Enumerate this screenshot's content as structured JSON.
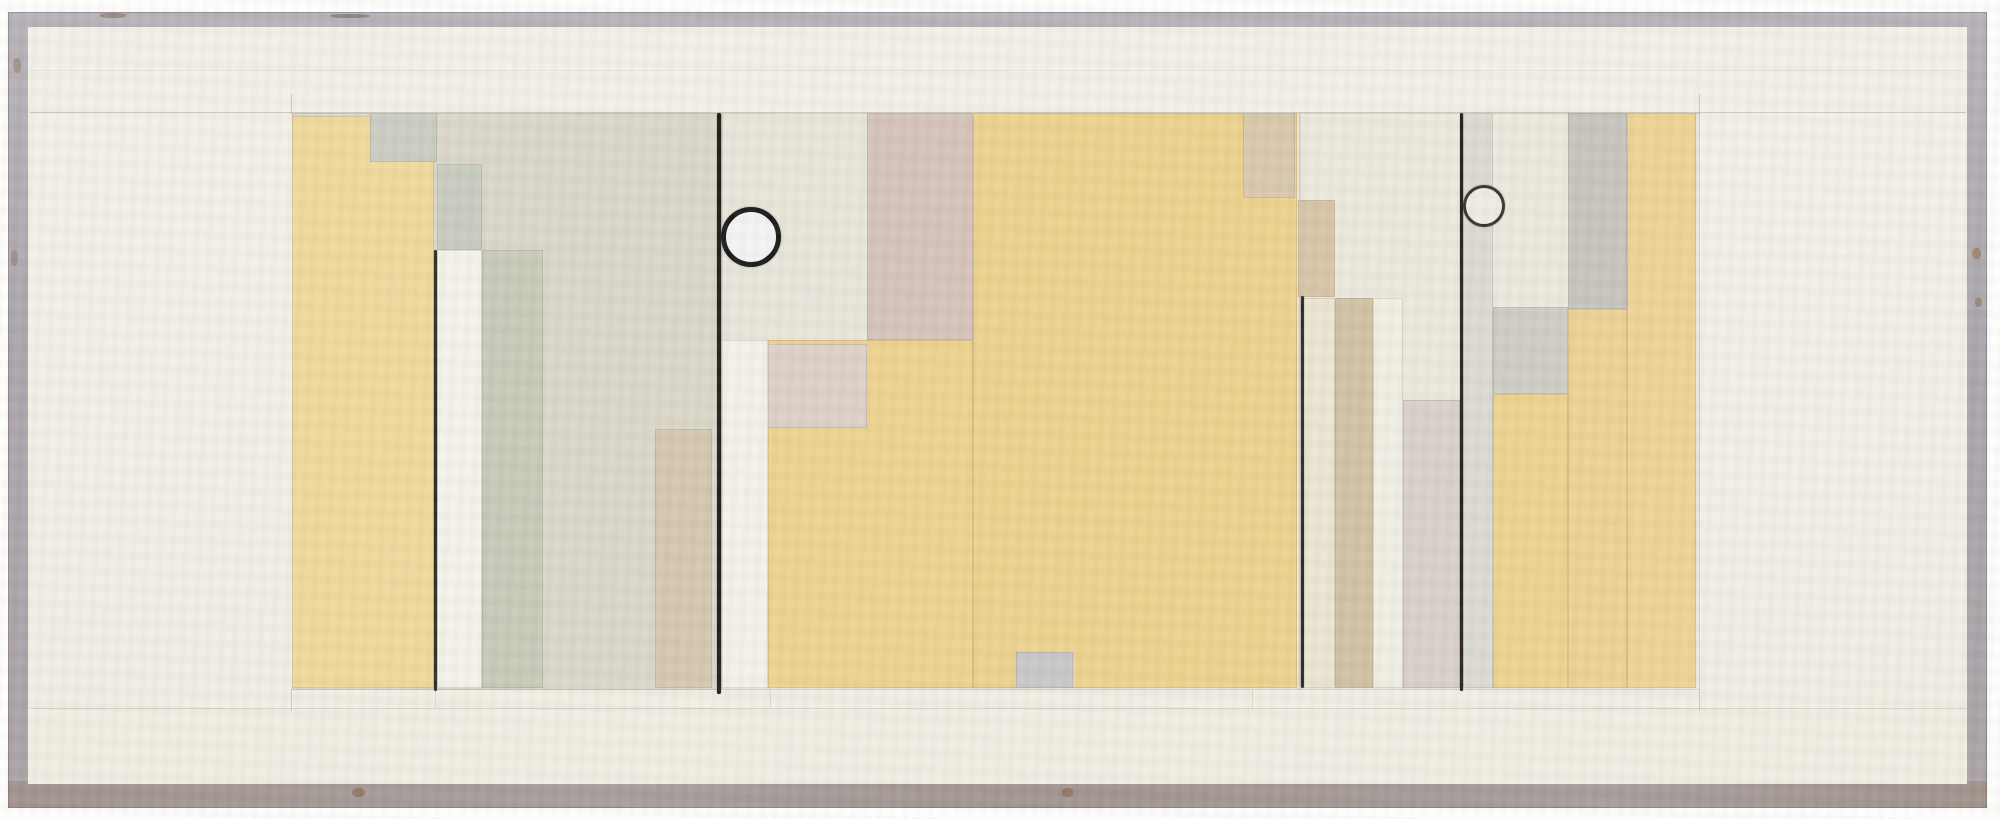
{
  "canvas": {
    "width": 2000,
    "height": 819
  },
  "palette": {
    "paper_outer": "#fdfdfc",
    "frame_gray": "#b2acb3",
    "frame_gray_dark": "#a39da5",
    "frame_rust": "#8a6a4a",
    "mat_cream": "#f1eee5",
    "graphite": "#1c1b17",
    "field_warm_gray": "#d9d6c9",
    "yellow_ochre": "#ecd18c",
    "pink_beige": "#d5c2b9",
    "olive_gray": "#c6c9b8",
    "tan_beige": "#d4c6ae",
    "white_paint": "#f4f2e8"
  },
  "frame": {
    "outer": {
      "x": 8,
      "y": 12,
      "w": 1979,
      "h": 796
    },
    "mat": {
      "x": 28,
      "y": 27,
      "w": 1939,
      "h": 757
    }
  },
  "composition": {
    "x": 292,
    "y": 113,
    "w": 1408,
    "h": 577
  },
  "shapes": [
    {
      "name": "field-left",
      "x": 292,
      "y": 113,
      "w": 430,
      "h": 577,
      "color": "#d9d6c9"
    },
    {
      "name": "field-middle",
      "x": 722,
      "y": 113,
      "w": 578,
      "h": 577,
      "color": "#e7e5da"
    },
    {
      "name": "field-right",
      "x": 1300,
      "y": 113,
      "w": 400,
      "h": 577,
      "color": "#eae8dd"
    },
    {
      "name": "yellow-block-left",
      "x": 292,
      "y": 116,
      "w": 142,
      "h": 572,
      "color": "#eed99b"
    },
    {
      "name": "gray-notch-square",
      "x": 370,
      "y": 113,
      "w": 67,
      "h": 49,
      "color": "#c9ccc1"
    },
    {
      "name": "gray-strip-upper",
      "x": 437,
      "y": 164,
      "w": 45,
      "h": 86,
      "color": "#c7cbbe"
    },
    {
      "name": "white-strip-left",
      "x": 437,
      "y": 250,
      "w": 45,
      "h": 438,
      "color": "#f4f2e8"
    },
    {
      "name": "olive-strip",
      "x": 482,
      "y": 250,
      "w": 61,
      "h": 438,
      "color": "#c6c9b8"
    },
    {
      "name": "tan-strip-left",
      "x": 655,
      "y": 429,
      "w": 57,
      "h": 259,
      "color": "#d4c6ae"
    },
    {
      "name": "white-strip-middle",
      "x": 722,
      "y": 340,
      "w": 46,
      "h": 348,
      "color": "#f3f1e7"
    },
    {
      "name": "yellow-field-lower",
      "x": 768,
      "y": 340,
      "w": 205,
      "h": 348,
      "color": "#ecd28e"
    },
    {
      "name": "pale-pink-rect",
      "x": 768,
      "y": 344,
      "w": 99,
      "h": 84,
      "color": "#dccfc7"
    },
    {
      "name": "deep-pink-rect",
      "x": 867,
      "y": 113,
      "w": 106,
      "h": 227,
      "color": "#d5c2b9"
    },
    {
      "name": "yellow-field-main",
      "x": 973,
      "y": 113,
      "w": 324,
      "h": 575,
      "color": "#ecd18c"
    },
    {
      "name": "tan-rect-top",
      "x": 1243,
      "y": 113,
      "w": 52,
      "h": 85,
      "color": "#d8c7aa"
    },
    {
      "name": "small-gray-square",
      "x": 1016,
      "y": 652,
      "w": 57,
      "h": 36,
      "color": "#c6c6c9"
    },
    {
      "name": "tan-rect-mid",
      "x": 1298,
      "y": 200,
      "w": 37,
      "h": 97,
      "color": "#d6c5a7"
    },
    {
      "name": "cream-strip-right",
      "x": 1303,
      "y": 298,
      "w": 32,
      "h": 390,
      "color": "#eae4d3"
    },
    {
      "name": "tan-strip-right",
      "x": 1335,
      "y": 298,
      "w": 38,
      "h": 390,
      "color": "#cfc1a3"
    },
    {
      "name": "white-strip-right",
      "x": 1373,
      "y": 298,
      "w": 30,
      "h": 390,
      "color": "#f0eee3"
    },
    {
      "name": "pinkgray-strip-right",
      "x": 1403,
      "y": 400,
      "w": 57,
      "h": 288,
      "color": "#d9cecb"
    },
    {
      "name": "gray-strip-rightline",
      "x": 1463,
      "y": 113,
      "w": 30,
      "h": 575,
      "color": "#dbd9d1"
    },
    {
      "name": "gray-square-right",
      "x": 1493,
      "y": 307,
      "w": 75,
      "h": 87,
      "color": "#cecbc5"
    },
    {
      "name": "darkgray-strip-right",
      "x": 1568,
      "y": 113,
      "w": 59,
      "h": 196,
      "color": "#c6c3bc"
    },
    {
      "name": "yellow-strip-right-mid",
      "x": 1568,
      "y": 309,
      "w": 59,
      "h": 379,
      "color": "#ecd192"
    },
    {
      "name": "yellow-block-right",
      "x": 1627,
      "y": 113,
      "w": 69,
      "h": 575,
      "color": "#edd293"
    },
    {
      "name": "yellow-block-right-lower",
      "x": 1493,
      "y": 394,
      "w": 75,
      "h": 294,
      "color": "#ecd28f"
    }
  ],
  "lines": [
    {
      "name": "black-line-left-short",
      "x": 434,
      "y": 250,
      "w": 3,
      "h": 441,
      "color": "#2b2924"
    },
    {
      "name": "black-line-main-left",
      "x": 717,
      "y": 113,
      "w": 4,
      "h": 581,
      "color": "#1c1b17"
    },
    {
      "name": "black-line-right-short",
      "x": 1301,
      "y": 296,
      "w": 3,
      "h": 392,
      "color": "#2b2924"
    },
    {
      "name": "black-line-main-right",
      "x": 1460,
      "y": 113,
      "w": 3,
      "h": 578,
      "color": "#221f1c"
    }
  ],
  "circles": [
    {
      "name": "circle-left",
      "cx": 751,
      "cy": 237,
      "r": 30,
      "ring": 5,
      "ring_color": "#161616",
      "fill": "#f2f3f4"
    },
    {
      "name": "circle-right",
      "cx": 1484,
      "cy": 206,
      "r": 21,
      "ring": 3,
      "ring_color": "#33312d",
      "fill": "#edebe2"
    }
  ],
  "pencil_lines": [
    {
      "name": "pencil-top-rule",
      "x": 30,
      "y": 112,
      "w": 1936,
      "h": 1,
      "opacity": 0.3
    },
    {
      "name": "pencil-upper-faint-rule",
      "x": 30,
      "y": 70,
      "w": 1936,
      "h": 1,
      "opacity": 0.1
    },
    {
      "name": "pencil-bottom-rule",
      "x": 30,
      "y": 708,
      "w": 1936,
      "h": 1,
      "opacity": 0.22
    },
    {
      "name": "pencil-tick-top-left",
      "x": 291,
      "y": 94,
      "w": 1,
      "h": 20,
      "opacity": 0.28
    },
    {
      "name": "pencil-tick-top-right",
      "x": 1699,
      "y": 94,
      "w": 1,
      "h": 20,
      "opacity": 0.28
    },
    {
      "name": "pencil-tick-bottom-left",
      "x": 291,
      "y": 689,
      "w": 1,
      "h": 22,
      "opacity": 0.28
    },
    {
      "name": "pencil-tick-bottom-right",
      "x": 1699,
      "y": 689,
      "w": 1,
      "h": 22,
      "opacity": 0.28
    },
    {
      "name": "pencil-tick-bottom-mid1",
      "x": 435,
      "y": 689,
      "w": 1,
      "h": 19,
      "opacity": 0.18
    },
    {
      "name": "pencil-tick-bottom-mid2",
      "x": 770,
      "y": 689,
      "w": 1,
      "h": 19,
      "opacity": 0.18
    },
    {
      "name": "pencil-tick-bottom-mid3",
      "x": 1252,
      "y": 690,
      "w": 1,
      "h": 19,
      "opacity": 0.18
    }
  ],
  "specks": [
    {
      "name": "frame-mark-top-1",
      "x": 100,
      "y": 13,
      "w": 26,
      "h": 5,
      "color": "rgba(122,94,62,0.50)"
    },
    {
      "name": "frame-mark-top-2",
      "x": 330,
      "y": 14,
      "w": 40,
      "h": 4,
      "color": "rgba(90,80,70,0.45)"
    },
    {
      "name": "frame-rust-right-1",
      "x": 1972,
      "y": 248,
      "w": 9,
      "h": 11,
      "color": "rgba(140,100,60,0.55)"
    },
    {
      "name": "frame-rust-right-2",
      "x": 1975,
      "y": 298,
      "w": 7,
      "h": 9,
      "color": "rgba(140,100,60,0.50)"
    },
    {
      "name": "frame-rust-bottom-1",
      "x": 352,
      "y": 788,
      "w": 13,
      "h": 9,
      "color": "rgba(125,92,58,0.55)"
    },
    {
      "name": "frame-rust-bottom-2",
      "x": 1062,
      "y": 788,
      "w": 11,
      "h": 9,
      "color": "rgba(125,92,58,0.50)"
    },
    {
      "name": "frame-rust-left-1",
      "x": 13,
      "y": 58,
      "w": 8,
      "h": 15,
      "color": "rgba(130,100,70,0.40)"
    },
    {
      "name": "frame-rust-left-2",
      "x": 11,
      "y": 250,
      "w": 7,
      "h": 16,
      "color": "rgba(130,100,70,0.35)"
    }
  ]
}
